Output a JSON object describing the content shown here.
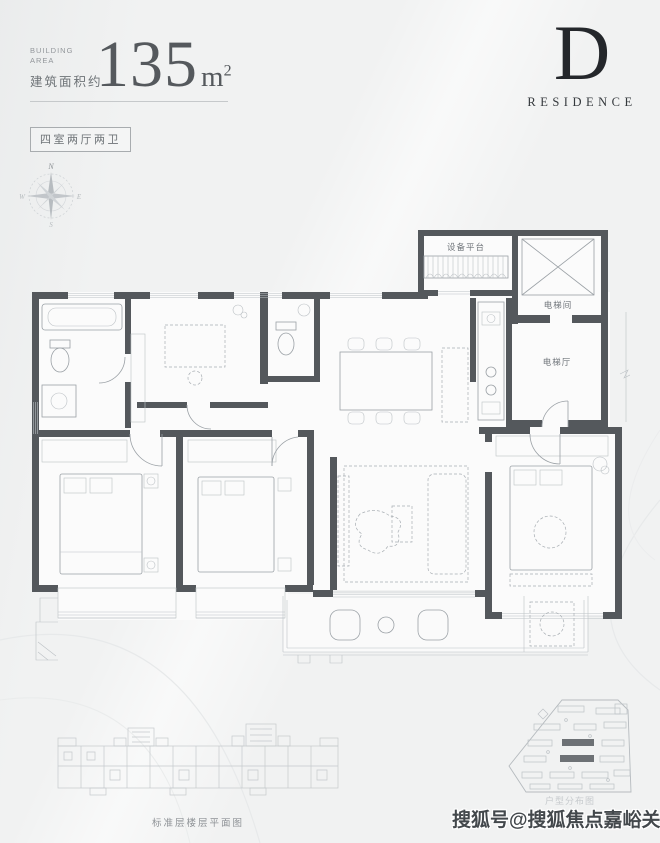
{
  "header": {
    "building_area_en": "BUILDING AREA",
    "building_area_zh": "建筑面积约",
    "area_value": "135",
    "area_unit_base": "m",
    "area_unit_exponent": "2",
    "unit_type": "四室两厅两卫"
  },
  "logo": {
    "letter": "D",
    "word": "RESIDENCE"
  },
  "compass": {
    "north": "N",
    "south": "S",
    "east": "E",
    "west": "W"
  },
  "floor_plan": {
    "labels": {
      "equipment_platform": "设备平台",
      "elevator_shaft": "电梯间",
      "elevator_hall": "电梯厅"
    }
  },
  "footer": {
    "standard_floor_caption": "标准层楼层平面图",
    "site_plan_caption": "户型分布图",
    "watermark": "搜狐号@搜狐焦点嘉峪关站"
  },
  "colors": {
    "wall": "#54585c",
    "accent_dark": "#24272b",
    "text_gray": "#6e7377",
    "highlight_building": "#6d7175"
  }
}
